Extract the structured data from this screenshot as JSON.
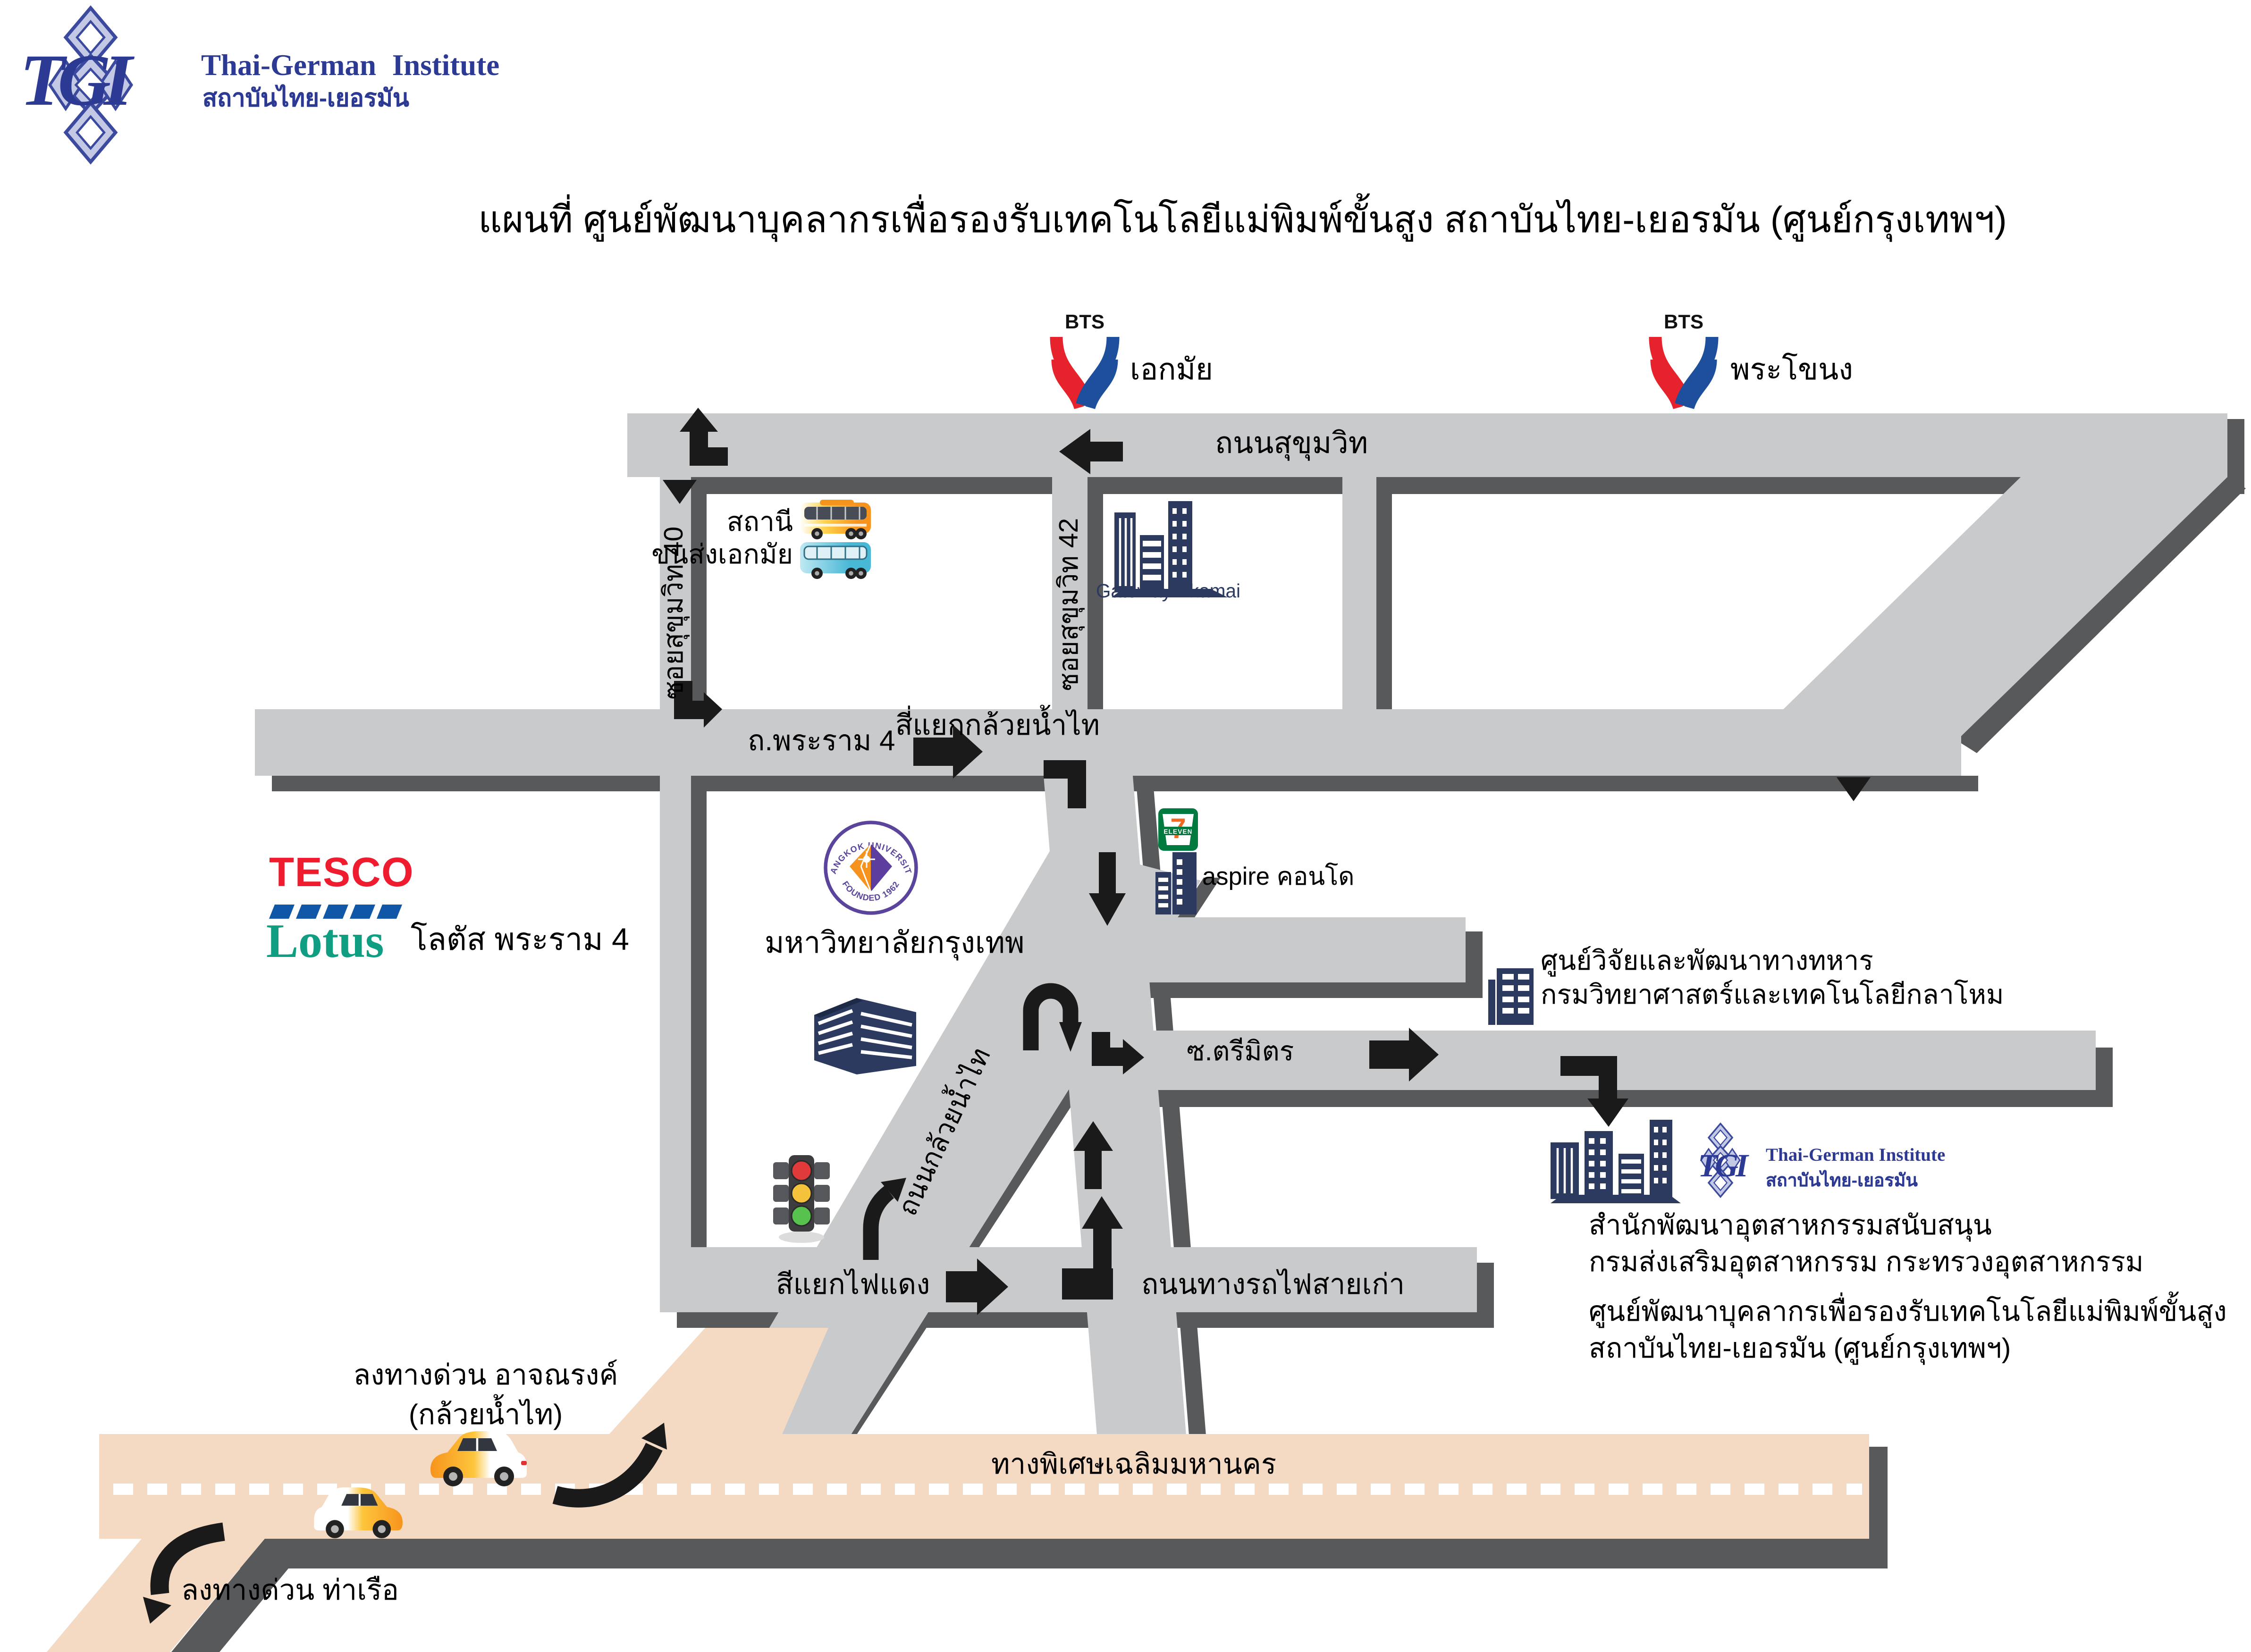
{
  "header": {
    "logo_letters": "TGI",
    "brand_en": "Thai-German Institute",
    "brand_th": "สถาบันไทย-เยอรมัน"
  },
  "title": "แผนที่ ศูนย์พัฒนาบุคลากรเพื่อรองรับเทคโนโลยีแม่พิมพ์ขั้นสูง สถาบันไทย-เยอรมัน (ศูนย์กรุงเทพฯ)",
  "bts": {
    "wordmark": "BTS",
    "ekamai": "เอกมัย",
    "phra_khanong": "พระโขนง"
  },
  "roads": {
    "sukhumvit": "ถนนสุขุมวิท",
    "soi40": "ซอยสุขุมวิท 40",
    "soi42": "ซอยสุขุมวิท 42",
    "rama4": "ถ.พระราม 4",
    "intersection": "สี่แยกกล้วยน้ำไท",
    "kluai_nam_thai": "ถนนกล้วยน้ำไท",
    "trimit": "ซ.ตรีมิตร",
    "railway": "ถนนทางรถไฟสายเก่า",
    "red_light": "สีแยกไฟแดง",
    "expressway": "ทางพิเศษเฉลิมมหานคร"
  },
  "places": {
    "bus_station": {
      "line1": "สถานี",
      "line2": "ขนส่งเอกมัย"
    },
    "gateway": "Gateway Ekamai",
    "tesco": {
      "word_top": "TESCO",
      "word_bottom": "Lotus",
      "label": "โลตัส พระราม 4"
    },
    "bangkok_university": {
      "seal_top": "BANGKOK UNIVERSITY",
      "seal_bottom": "FOUNDED 1962",
      "label": "มหาวิทยาลัยกรุงเทพ"
    },
    "seven_eleven": {
      "digit": "7",
      "word": "ELEVEN"
    },
    "aspire": "aspire คอนโด",
    "military": {
      "line1": "ศูนย์วิจัยและพัฒนาทางทหาร",
      "line2": "กรมวิทยาศาสตร์และเทคโนโลยีกลาโหม"
    },
    "tgi_site": {
      "logo_letters": "TGI",
      "brand_en": "Thai-German Institute",
      "brand_th": "สถาบันไทย-เยอรมัน",
      "line1": "สำนักพัฒนาอุตสาหกรรมสนับสนุน",
      "line2": "กรมส่งเสริมอุตสาหกรรม กระทรวงอุตสาหกรรม",
      "line3": "ศูนย์พัฒนาบุคลากรเพื่อรองรับเทคโนโลยีแม่พิมพ์ขั้นสูง",
      "line4": "สถาบันไทย-เยอรมัน (ศูนย์กรุงเทพฯ)"
    }
  },
  "exits": {
    "achanarong_line1": "ลงทางด่วน อาจณรงค์",
    "achanarong_line2": "(กล้วยน้ำไท)",
    "port": "ลงทางด่วน ท่าเรือ"
  },
  "colors": {
    "road_gray": "#c9cacc",
    "road_shadow": "#58595b",
    "expressway_peach": "#f4d9c3",
    "arrow_black": "#1a1a1a",
    "brand_navy": "#2d3a94",
    "building_navy": "#2b3a5e",
    "bts_red": "#e6232d",
    "bts_blue": "#1e4f9c",
    "tesco_red": "#ee1c2e",
    "tesco_blue": "#1057a8",
    "lotus_green": "#0f9e82",
    "bu_purple": "#5b3e9e",
    "bu_orange": "#f6921e",
    "traffic_red": "#e03a3a",
    "traffic_yellow": "#f5c23c",
    "traffic_green": "#58c24e",
    "car_orange": "#f7941d"
  }
}
